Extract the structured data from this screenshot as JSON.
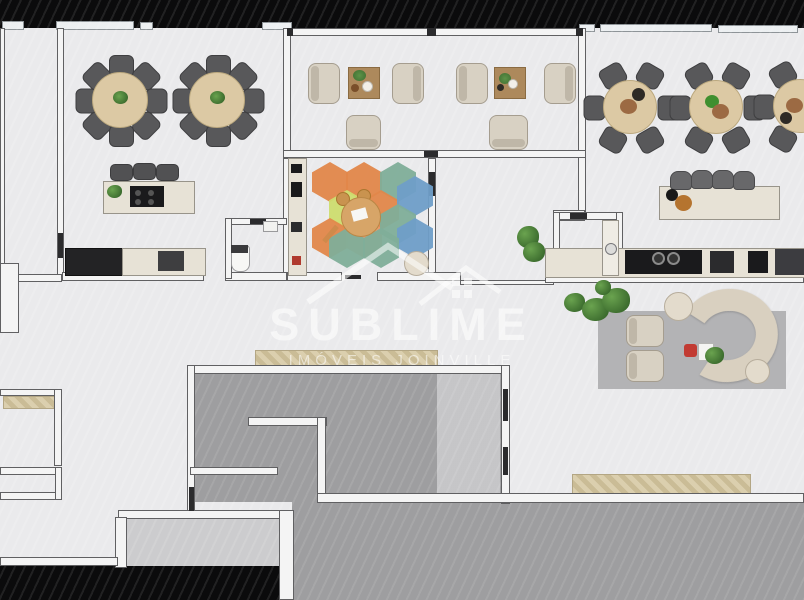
{
  "watermark": {
    "title": "SUBLIME",
    "subtitle": "IMÓVEIS JOINVILLE",
    "logo": "twin-houses-outline"
  },
  "palette": {
    "floor": "#ebebed",
    "wall_fill": "#f4f4f4",
    "wall_edge": "#606062",
    "exterior_black": "#0b0b0c",
    "concrete": "#9e9ea0",
    "concrete_light": "#c6c6c8",
    "room_floor_light": "#cdcdcf",
    "table_wood": "#dcc9a4",
    "chair_dark": "#58585a",
    "counter_light": "#e7e2d6",
    "appliance_dark": "#1a1a1c",
    "rug_gray": "#b3b3b5",
    "rug_orange": "#e1874a",
    "rug_teal": "#7fae99",
    "rug_blue": "#6f9ec8",
    "rug_yellow": "#cedd6f",
    "rug_salmon": "#e89a6a",
    "plant_green": "#4c7d3c",
    "sofa_cream": "#d9d0c0",
    "watermark_white": "rgba(255,255,255,0.55)"
  }
}
